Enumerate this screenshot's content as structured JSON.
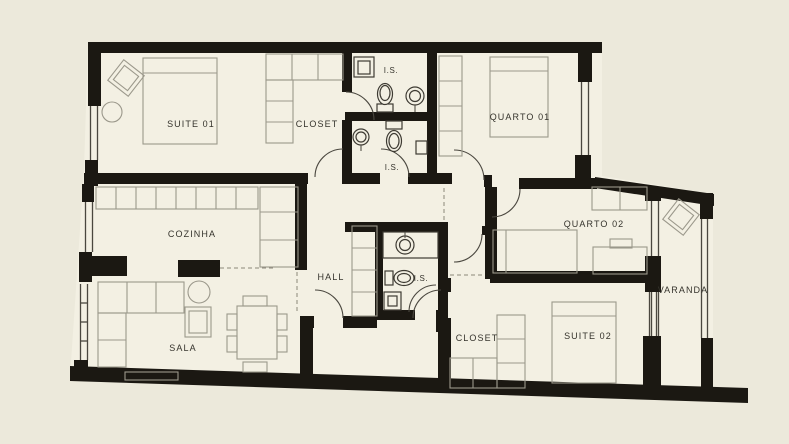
{
  "title": "Apartment floor plan",
  "colors": {
    "background": "#ece9db",
    "floor": "#f3f0e3",
    "wall": "#1b1812",
    "furniture_line": "#9b988b",
    "label_text": "#35332c"
  },
  "rooms": {
    "suite01": {
      "label": "SUITE 01"
    },
    "closet01": {
      "label": "CLOSET"
    },
    "is_top": {
      "label": "I.S."
    },
    "is_second": {
      "label": "I.S."
    },
    "quarto01": {
      "label": "QUARTO 01"
    },
    "cozinha": {
      "label": "COZINHA"
    },
    "hall": {
      "label": "HALL"
    },
    "is_hall": {
      "label": "I.S."
    },
    "quarto02": {
      "label": "QUARTO 02"
    },
    "varanda": {
      "label": "VARANDA"
    },
    "sala": {
      "label": "SALA"
    },
    "closet02": {
      "label": "CLOSET"
    },
    "suite02": {
      "label": "SUITE 02"
    }
  }
}
